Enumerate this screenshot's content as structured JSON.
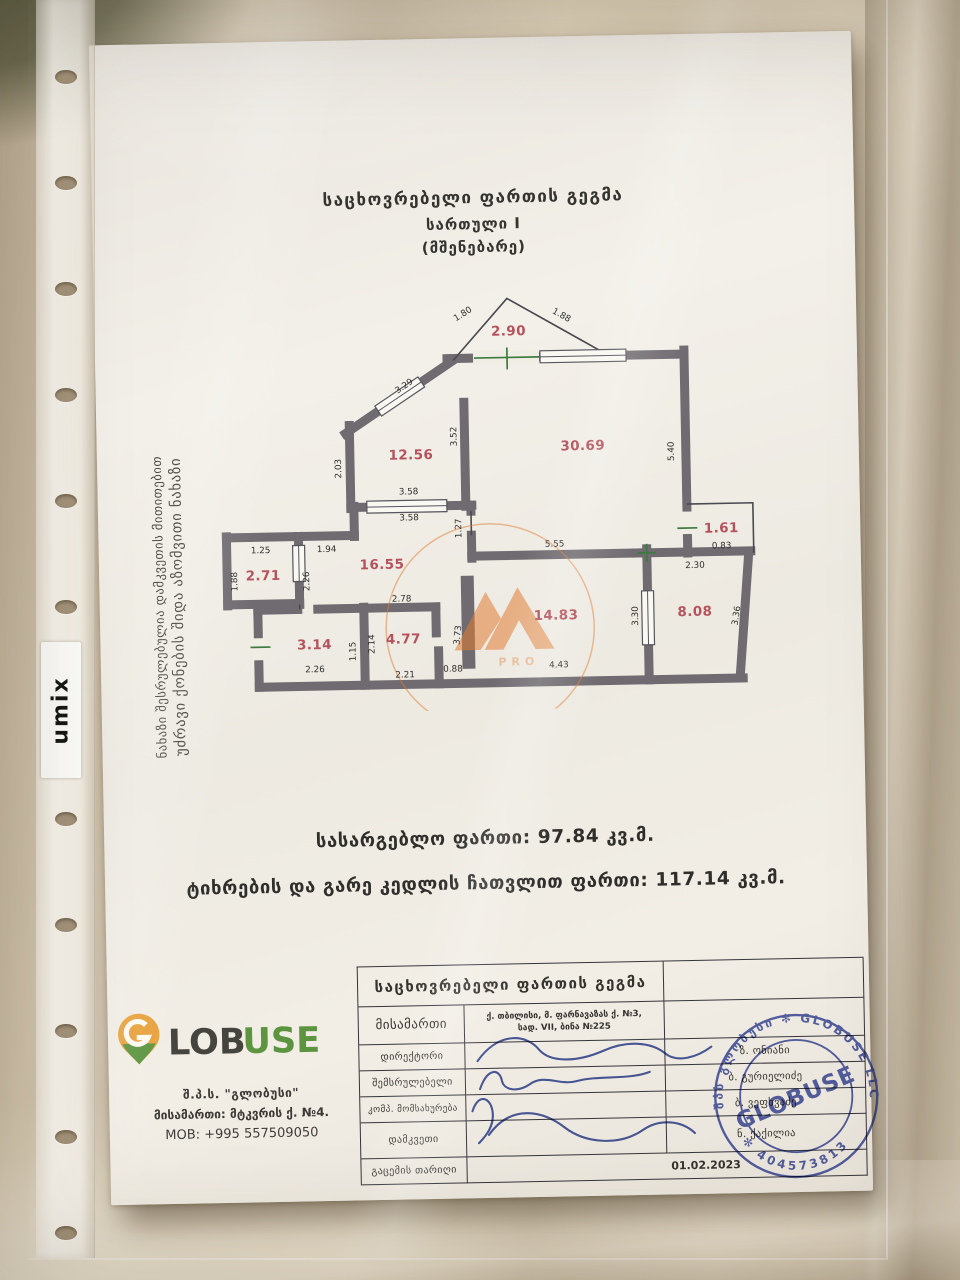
{
  "scene": {
    "sleeve_brand": "umix"
  },
  "document": {
    "title": {
      "line1": "საცხოვრებელი ფართის გეგმა",
      "line2": "სართული I",
      "line3": "(მშენებარე)"
    },
    "side_note": {
      "line1": "უძრავი ქონების შიდა აზომვითი ნახაზი",
      "line2": "ნახაზი შესრულებულია დამკვეთის მითითებით"
    },
    "summary": {
      "useful_label": "სასარგებლო ფართი:",
      "useful_value": "97.84 კვ.მ.",
      "total_label": "ტიხრების და გარე კედლის ჩათვლით ფართი:",
      "total_value": "117.14 კვ.მ."
    }
  },
  "plan": {
    "watermark_text": "PRO",
    "rooms": [
      {
        "area": "2.90",
        "x": 296,
        "y": 46
      },
      {
        "area": "12.56",
        "x": 196,
        "y": 168
      },
      {
        "area": "30.69",
        "x": 368,
        "y": 162
      },
      {
        "area": "1.61",
        "x": 505,
        "y": 247
      },
      {
        "area": "2.71",
        "x": 46,
        "y": 286
      },
      {
        "area": "16.55",
        "x": 165,
        "y": 277
      },
      {
        "area": "3.14",
        "x": 96,
        "y": 356
      },
      {
        "area": "4.77",
        "x": 185,
        "y": 352
      },
      {
        "area": "14.83",
        "x": 338,
        "y": 331
      },
      {
        "area": "8.08",
        "x": 477,
        "y": 330
      }
    ],
    "dimensions": [
      {
        "v": "1.80",
        "x": 252,
        "y": 26,
        "r": -31
      },
      {
        "v": "1.88",
        "x": 348,
        "y": 29,
        "r": 30
      },
      {
        "v": "3.29",
        "x": 192,
        "y": 97,
        "r": -33
      },
      {
        "v": "2.03",
        "x": 126,
        "y": 176,
        "r": -90
      },
      {
        "v": "3.52",
        "x": 242,
        "y": 146,
        "r": -90
      },
      {
        "v": "5.40",
        "x": 459,
        "y": 165,
        "r": -90
      },
      {
        "v": "3.58",
        "x": 193,
        "y": 203,
        "r": 0
      },
      {
        "v": "3.58",
        "x": 193,
        "y": 229,
        "r": 0
      },
      {
        "v": "1.27",
        "x": 245,
        "y": 238,
        "r": -90
      },
      {
        "v": "5.55",
        "x": 338,
        "y": 258,
        "r": 0
      },
      {
        "v": "0.83",
        "x": 505,
        "y": 263,
        "r": 0
      },
      {
        "v": "2.30",
        "x": 478,
        "y": 282,
        "r": 0
      },
      {
        "v": "1.25",
        "x": 44,
        "y": 259,
        "r": 0
      },
      {
        "v": "1.94",
        "x": 110,
        "y": 259,
        "r": 0
      },
      {
        "v": "1.88",
        "x": 20,
        "y": 287,
        "r": -90
      },
      {
        "v": "2.26",
        "x": 92,
        "y": 288,
        "r": -90
      },
      {
        "v": "2.78",
        "x": 184,
        "y": 310,
        "r": 0
      },
      {
        "v": "2.14",
        "x": 156,
        "y": 352,
        "r": -90
      },
      {
        "v": "1.15",
        "x": 137,
        "y": 359,
        "r": -90
      },
      {
        "v": "3.73",
        "x": 242,
        "y": 345,
        "r": -83
      },
      {
        "v": "2.26",
        "x": 96,
        "y": 379,
        "r": 0
      },
      {
        "v": "2.21",
        "x": 186,
        "y": 386,
        "r": 0
      },
      {
        "v": "0.88",
        "x": 234,
        "y": 381,
        "r": 0
      },
      {
        "v": "4.43",
        "x": 340,
        "y": 379,
        "r": 0
      },
      {
        "v": "3.30",
        "x": 420,
        "y": 329,
        "r": -90
      },
      {
        "v": "3.36",
        "x": 521,
        "y": 331,
        "r": -80
      }
    ]
  },
  "table": {
    "header": "საცხოვრებელი ფართის გეგმა",
    "address_label": "მისამართი",
    "address_line1": "ქ. თბილისი, მ. ფარნავაზას ქ. №3,",
    "address_line2": "სად. VII, ბინა №225",
    "rows": [
      {
        "label": "დირექტორი",
        "name": "ზ. ონიანი"
      },
      {
        "label": "შემსრულებელი",
        "name": "ბ. გურიელიძე"
      },
      {
        "label": "კომპ. მომსახურება",
        "name": "ბ. ვეფხვაძე"
      },
      {
        "label": "დამკვეთი",
        "name": "ნ. ქაქილია"
      }
    ],
    "date_label": "გაცემის თარიღი",
    "date_value": "01.02.2023"
  },
  "company": {
    "brand_lob": "LOB",
    "brand_use": "USE",
    "line1": "შ.პ.ს. \"გლობუსი\"",
    "line2": "მისამართი: მტკვრის ქ. №4.",
    "line3": "MOB: +995 557509050"
  },
  "stamp": {
    "ring_text": "შპს გლობუსი ✻ GLOBUSE LLC",
    "ring_number": "✻ 404573813 ✻",
    "center": "GLOBUSE"
  },
  "colors": {
    "accent_red": "#b5525c",
    "wall_gray": "#6f6b70",
    "opening_green": "#3e7a40",
    "stamp_blue": "#3a49a3",
    "watermark_orange": "#e07b33"
  }
}
